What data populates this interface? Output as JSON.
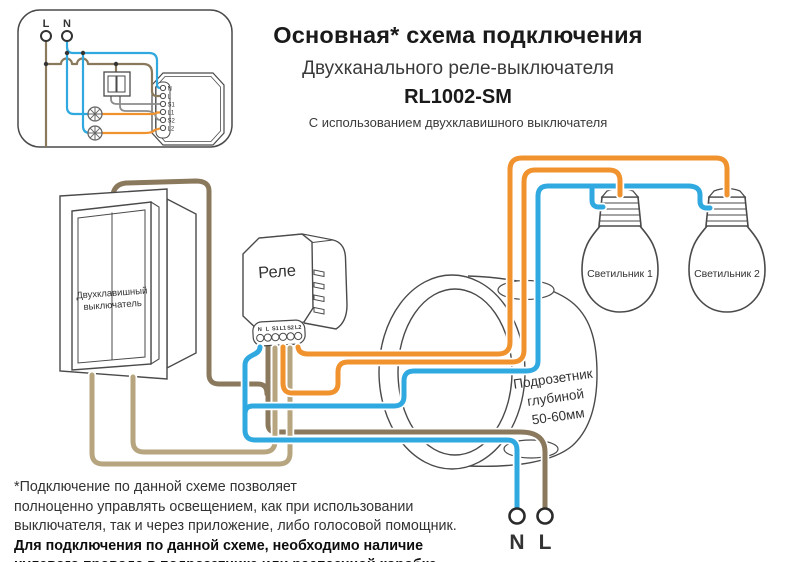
{
  "header": {
    "title": "Основная* схема подключения",
    "subtitle": "Двухканального реле-выключателя",
    "model": "RL1002-SM",
    "note": "С использованием двухклавишного выключателя"
  },
  "inset": {
    "line_label": "L",
    "neutral_label": "N",
    "relay_terminals": [
      "N",
      "L",
      "S1",
      "L1",
      "S2",
      "L2"
    ]
  },
  "main": {
    "switch_label": [
      "Двухклавишный",
      "выключатель"
    ],
    "relay_label": "Реле",
    "relay_terminals": [
      "N",
      "L",
      "S1",
      "L1",
      "S2",
      "L2"
    ],
    "box_label": [
      "Подрозетник",
      "глубиной",
      "50-60мм"
    ],
    "lamp1_label": "Светильник 1",
    "lamp2_label": "Светильник 2",
    "mains_neutral_label": "N",
    "mains_line_label": "L"
  },
  "footnote": {
    "lines": [
      "*Подключение по данной схеме позволяет",
      "полноценно управлять освещением, как при использовании",
      "выключателя, так и через приложение, либо голосовой помощник."
    ],
    "bold_lines": [
      "Для подключения по данной схеме, необходимо наличие",
      "нулевого провода в подрозетнике или распаечной коробке."
    ]
  },
  "colors": {
    "wire_blue": "#2FA9DF",
    "wire_orange": "#F0922E",
    "wire_brown": "#8A795C",
    "wire_tan": "#B6A57E",
    "wire_gray": "#8C8C8C",
    "outline": "#4A4A4A"
  }
}
